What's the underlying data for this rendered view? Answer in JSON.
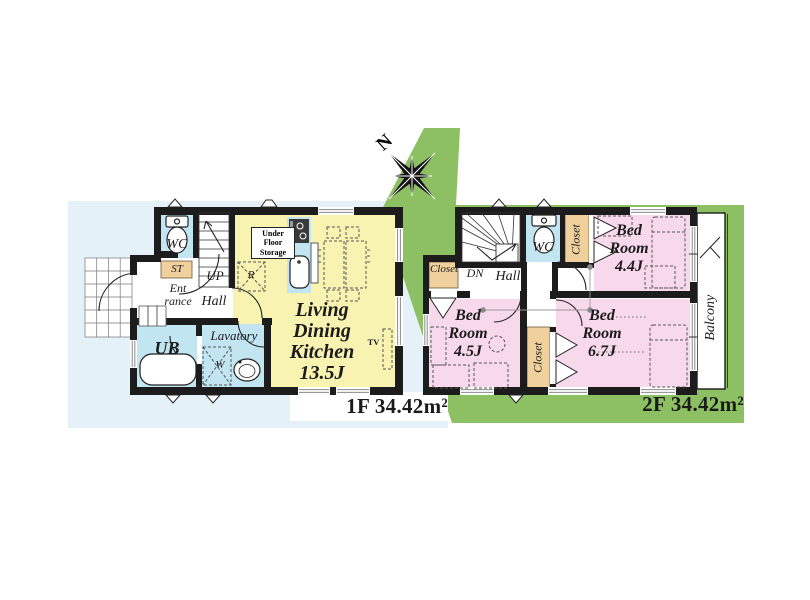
{
  "compass": {
    "north_label": "N"
  },
  "floor1": {
    "area_label": "1F 34.42m²",
    "labels": {
      "wc": "WC",
      "storage": "ST",
      "entrance": "Ent\nrance",
      "hall": "Hall",
      "stairs_up": "UP",
      "unit_bath": "UB",
      "lavatory": "Lavatory",
      "washer": "W",
      "refrigerator": "R",
      "under_floor_storage": "Under\nFloor\nStorage",
      "ldk": "Living\nDining\nKitchen\n13.5J",
      "tv": "TV"
    }
  },
  "floor2": {
    "area_label": "2F 34.42m²",
    "labels": {
      "stairs_down": "DN",
      "hall": "Hall",
      "wc": "WC",
      "closet_top": "Closet",
      "closet_left": "Closet",
      "closet_mid": "Closet",
      "bedroom_a": "Bed\nRoom\n4.4J",
      "bedroom_b": "Bed\nRoom\n4.5J",
      "bedroom_c": "Bed\nRoom\n6.7J",
      "balcony": "Balcony"
    }
  },
  "palette": {
    "background_blue": "#e5f1f8",
    "site_green": "#8cc063",
    "room_yellow": "#f9f3b2",
    "room_pink": "#f8d9ec",
    "room_blue": "#c2e5f2",
    "closet_tan": "#f0d09c",
    "wall": "#1c1c1c"
  }
}
